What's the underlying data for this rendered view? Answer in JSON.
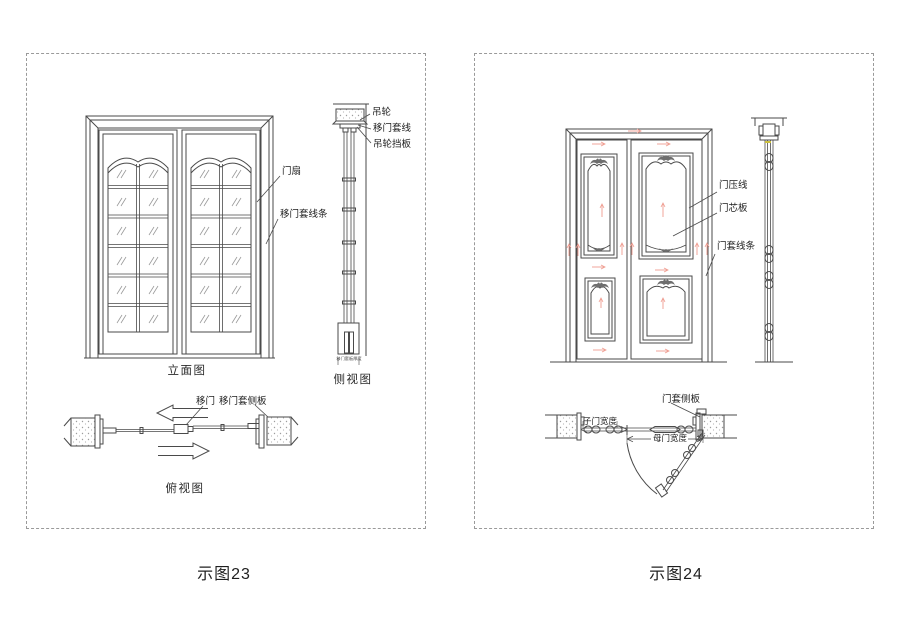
{
  "page": {
    "background": "#ffffff",
    "line_color": "#4a4a4a",
    "red_accent": "#ef9c90",
    "dash_border_color": "#9a9a9a"
  },
  "figure23": {
    "caption": "示图23",
    "view_labels": {
      "elevation": "立面图",
      "side": "侧视图",
      "top": "俯视图"
    },
    "part_labels": {
      "hanging_wheel": "吊轮",
      "sliding_door_casing_line": "移门套线",
      "hanging_wheel_baffle": "吊轮挡板",
      "door_leaf": "门扇",
      "sliding_door_casing_molding": "移门套线条",
      "sliding_door": "移门",
      "sliding_door_casing_side_panel": "移门套侧板",
      "casing_board_thickness": "移门套板厚度"
    }
  },
  "figure24": {
    "caption": "示图24",
    "part_labels": {
      "door_pressing_line": "门压线",
      "door_core_panel": "门芯板",
      "door_casing_molding": "门套线条",
      "door_casing_side_panel": "门套侧板",
      "son_door_width": "子门宽度",
      "mother_door_width": "母门宽度"
    }
  }
}
